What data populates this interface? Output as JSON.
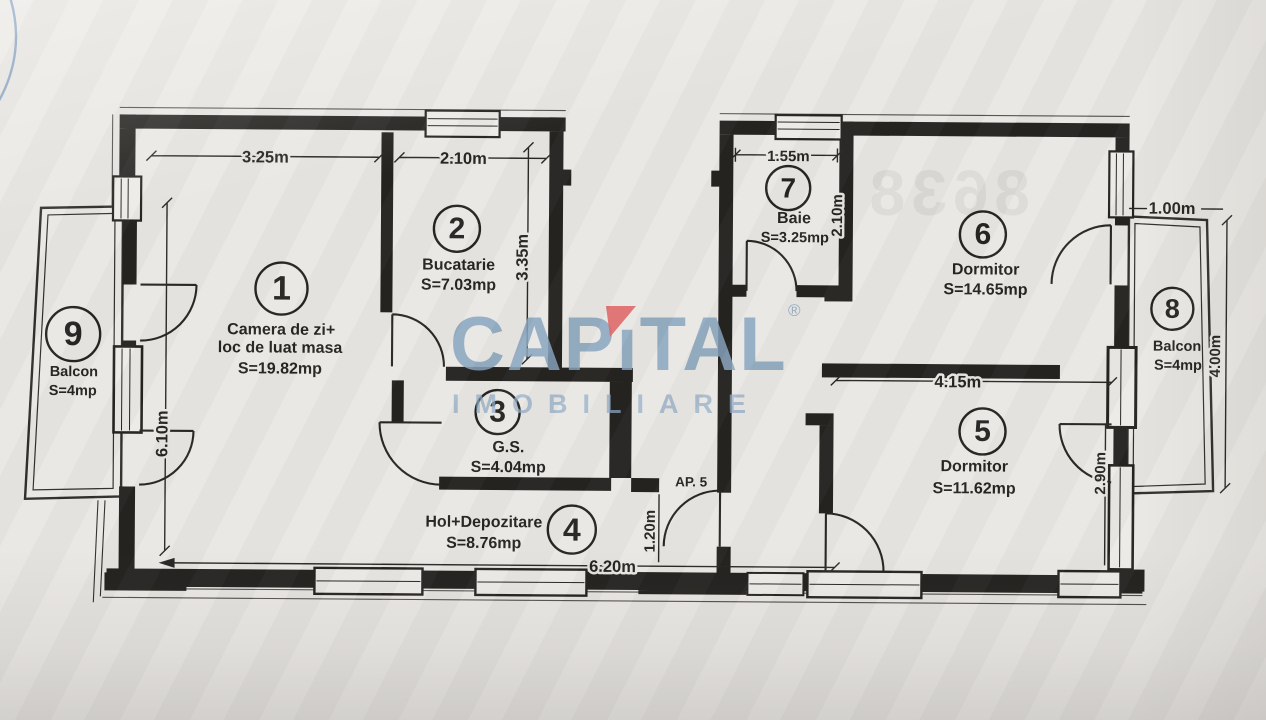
{
  "watermark": {
    "brand_left": "CAP",
    "brand_i": "ı",
    "brand_right": "TAL",
    "registered": "®",
    "subtitle": "IMOBILIARE",
    "brand_color": "#84a1bd",
    "accent_color": "#dd5f5f"
  },
  "plan": {
    "unit_label": "AP. 5",
    "rooms": [
      {
        "number": "1",
        "name": "Camera de zi+",
        "name_line2": "loc de luat masa",
        "area": "S=19.82mp"
      },
      {
        "number": "2",
        "name": "Bucatarie",
        "area": "S=7.03mp"
      },
      {
        "number": "3",
        "name": "G.S.",
        "area": "S=4.04mp"
      },
      {
        "number": "4",
        "name": "Hol+Depozitare",
        "area": "S=8.76mp"
      },
      {
        "number": "5",
        "name": "Dormitor",
        "area": "S=11.62mp"
      },
      {
        "number": "6",
        "name": "Dormitor",
        "area": "S=14.65mp"
      },
      {
        "number": "7",
        "name": "Baie",
        "area": "S=3.25mp"
      },
      {
        "number": "8",
        "name": "Balcon",
        "area": "S=4mp"
      },
      {
        "number": "9",
        "name": "Balcon",
        "area": "S=4mp"
      }
    ],
    "dimensions": {
      "living_width": "3.25m",
      "kitchen_width": "2.10m",
      "living_height": "6.10m",
      "kitchen_height": "3.35m",
      "bath_width": "1.55m",
      "bath_height": "2.10m",
      "bedroom5_width": "4.15m",
      "bedroom5_height": "2.90m",
      "balcony8_width": "1.00m",
      "balcony8_height": "4.00m",
      "entry_nook": "1.20m",
      "bottom_width": "6.20m"
    }
  },
  "artifacts": {
    "bleed_digits": "8638"
  }
}
